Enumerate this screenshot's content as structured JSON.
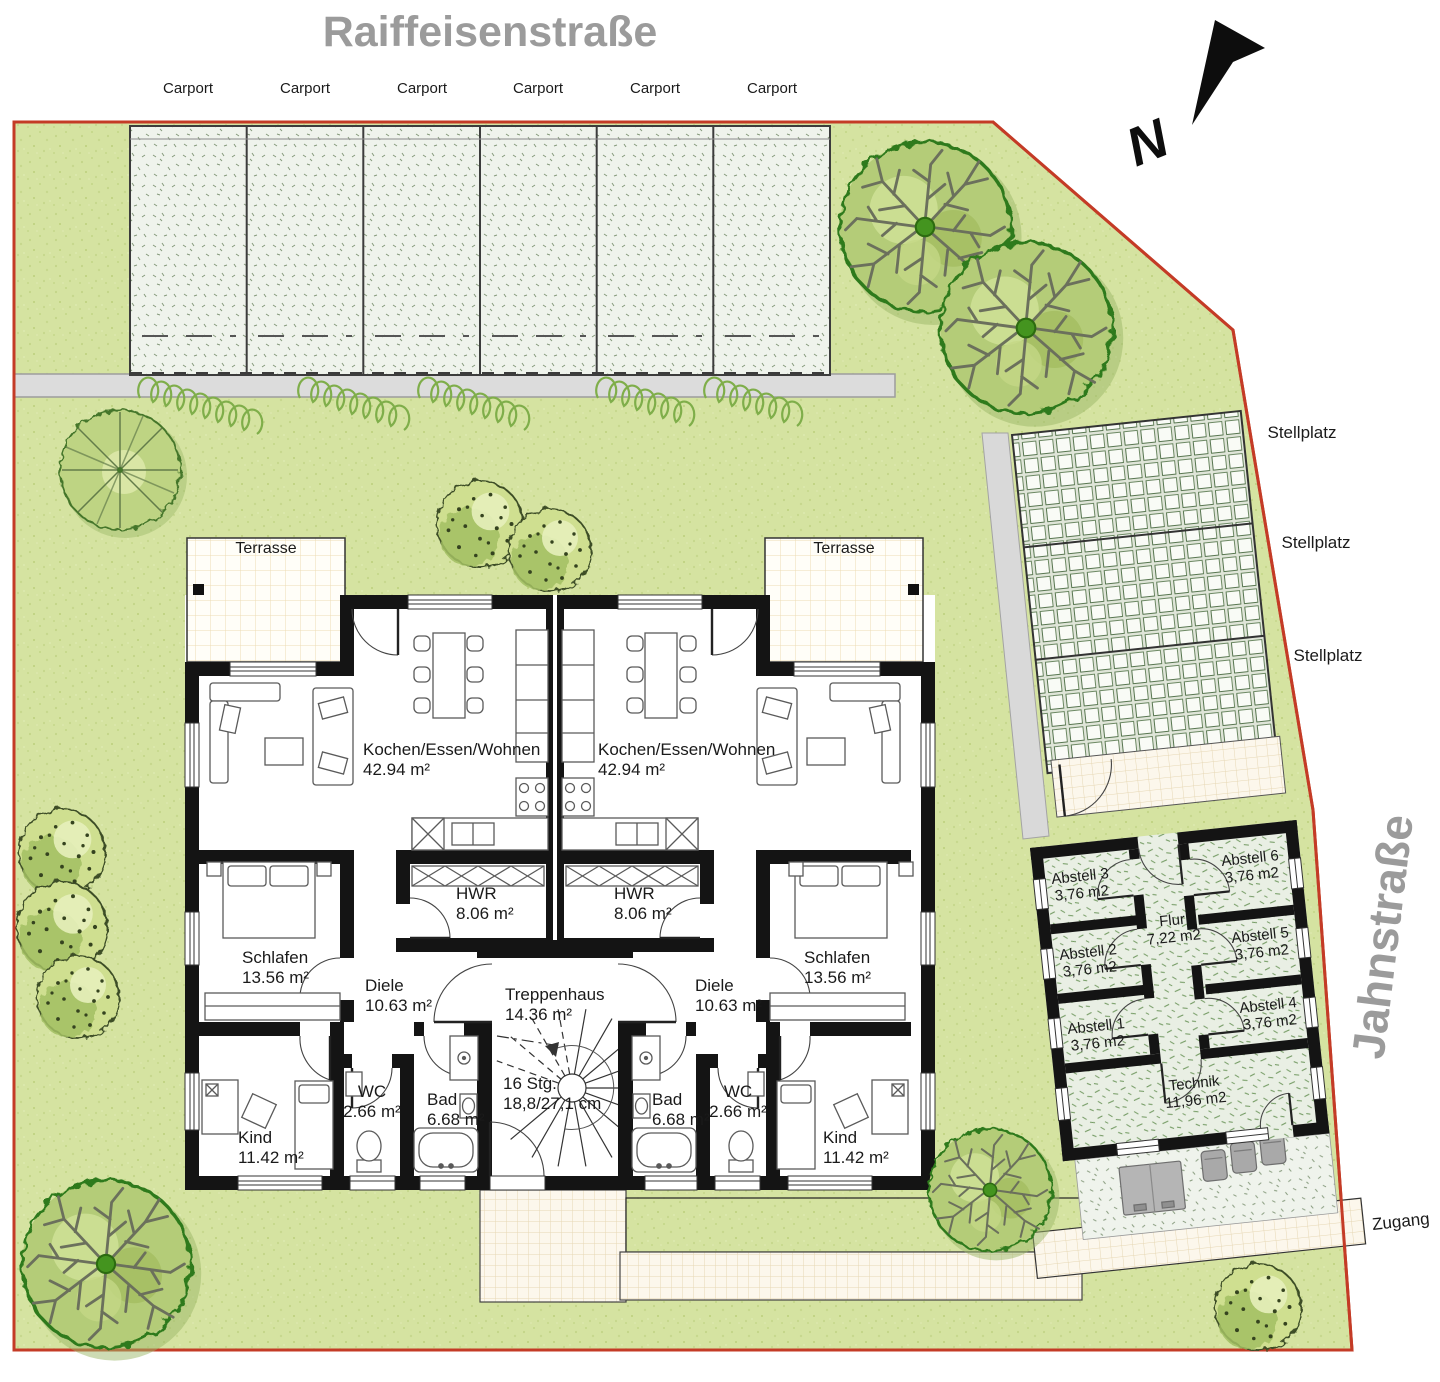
{
  "streets": {
    "top": "Raiffeisenstraße",
    "right": "Jahnstraße"
  },
  "compass": {
    "label": "N"
  },
  "carports": {
    "labels": [
      "Carport",
      "Carport",
      "Carport",
      "Carport",
      "Carport",
      "Carport"
    ]
  },
  "parking": {
    "labels": [
      "Stellplatz",
      "Stellplatz",
      "Stellplatz"
    ]
  },
  "access": {
    "zugang": "Zugang"
  },
  "terraces": {
    "left": "Terrasse",
    "right": "Terrasse"
  },
  "units": {
    "left": {
      "living": {
        "name": "Kochen/Essen/Wohnen",
        "area": "42.94 m²"
      },
      "hwr": {
        "name": "HWR",
        "area": "8.06 m²"
      },
      "schlafen": {
        "name": "Schlafen",
        "area": "13.56 m²"
      },
      "diele": {
        "name": "Diele",
        "area": "10.63 m²"
      },
      "wc": {
        "name": "WC",
        "area": "2.66 m²"
      },
      "bad": {
        "name": "Bad",
        "area": "6.68 m²"
      },
      "kind": {
        "name": "Kind",
        "area": "11.42 m²"
      }
    },
    "right": {
      "living": {
        "name": "Kochen/Essen/Wohnen",
        "area": "42.94 m²"
      },
      "hwr": {
        "name": "HWR",
        "area": "8.06 m²"
      },
      "schlafen": {
        "name": "Schlafen",
        "area": "13.56 m²"
      },
      "diele": {
        "name": "Diele",
        "area": "10.63 m²"
      },
      "wc": {
        "name": "WC",
        "area": "2.66 m²"
      },
      "bad": {
        "name": "Bad",
        "area": "6.68 m²"
      },
      "kind": {
        "name": "Kind",
        "area": "11.42 m²"
      }
    }
  },
  "stairwell": {
    "name": "Treppenhaus",
    "area": "14.36 m²",
    "stairs_line1": "16 Stg.",
    "stairs_line2": "18,8/27,1 cm"
  },
  "outbuilding": {
    "abstell1": {
      "name": "Abstell 1",
      "area": "3,76 m2"
    },
    "abstell2": {
      "name": "Abstell 2",
      "area": "3,76 m2"
    },
    "abstell3": {
      "name": "Abstell 3",
      "area": "3,76 m2"
    },
    "abstell4": {
      "name": "Abstell 4",
      "area": "3,76 m2"
    },
    "abstell5": {
      "name": "Abstell 5",
      "area": "3,76 m2"
    },
    "abstell6": {
      "name": "Abstell 6",
      "area": "3,76 m2"
    },
    "flur": {
      "name": "Flur",
      "area": "7,22 m2"
    },
    "technik": {
      "name": "Technik",
      "area": "11,96 m2"
    }
  },
  "colors": {
    "lawn": "#d5e3a1",
    "boundary_red": "#c43b26",
    "street_text_gray": "#9b9b9b",
    "wall_black": "#141414",
    "driveway_gray": "#dcdcdc",
    "hedge_green": "#7fae4a",
    "tree_fill": "#b4cc78",
    "tree_outline": "#2f7a1d"
  }
}
